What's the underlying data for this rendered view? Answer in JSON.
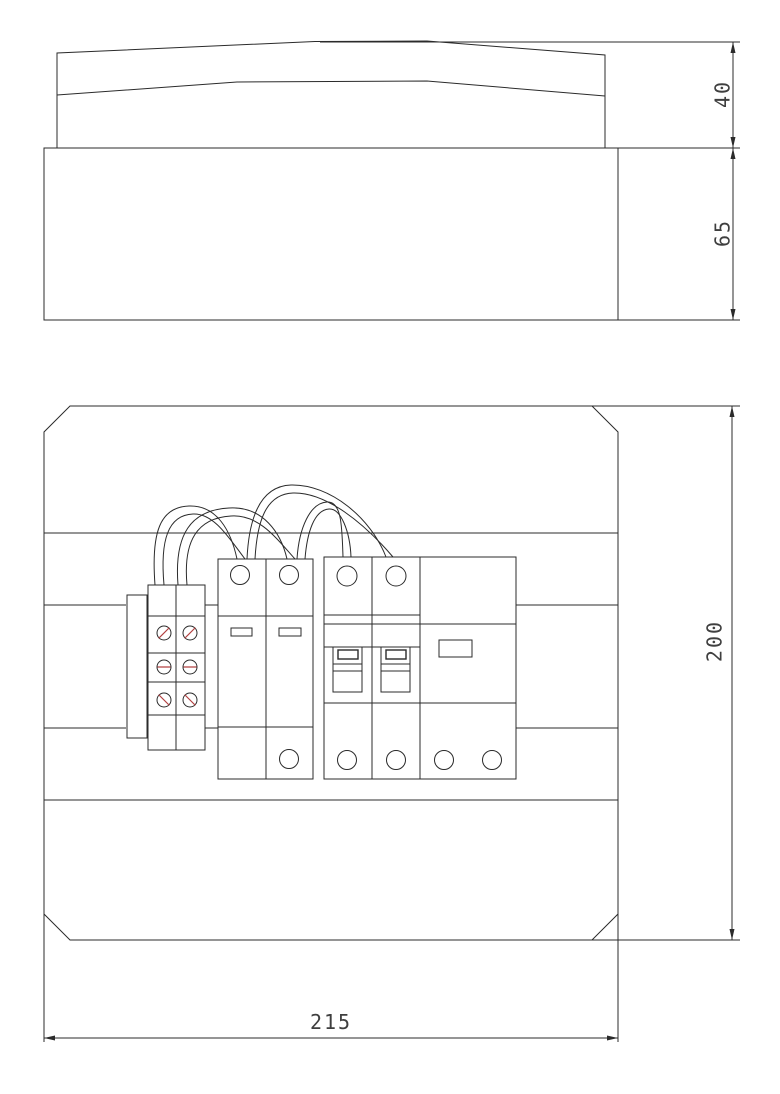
{
  "drawing": {
    "type": "technical-cad-drawing",
    "views": {
      "side_view": {
        "name": "enclosure-side-elevation"
      },
      "front_view": {
        "name": "enclosure-front-panel"
      }
    },
    "dimensions": {
      "lid_height": "40",
      "base_height": "65",
      "panel_height": "200",
      "panel_width": "215"
    },
    "colors": {
      "line": "#2b2b2b",
      "screw_slash": "#b24040",
      "dimension_text": "#3f3f3f",
      "background": "#ffffff"
    }
  }
}
